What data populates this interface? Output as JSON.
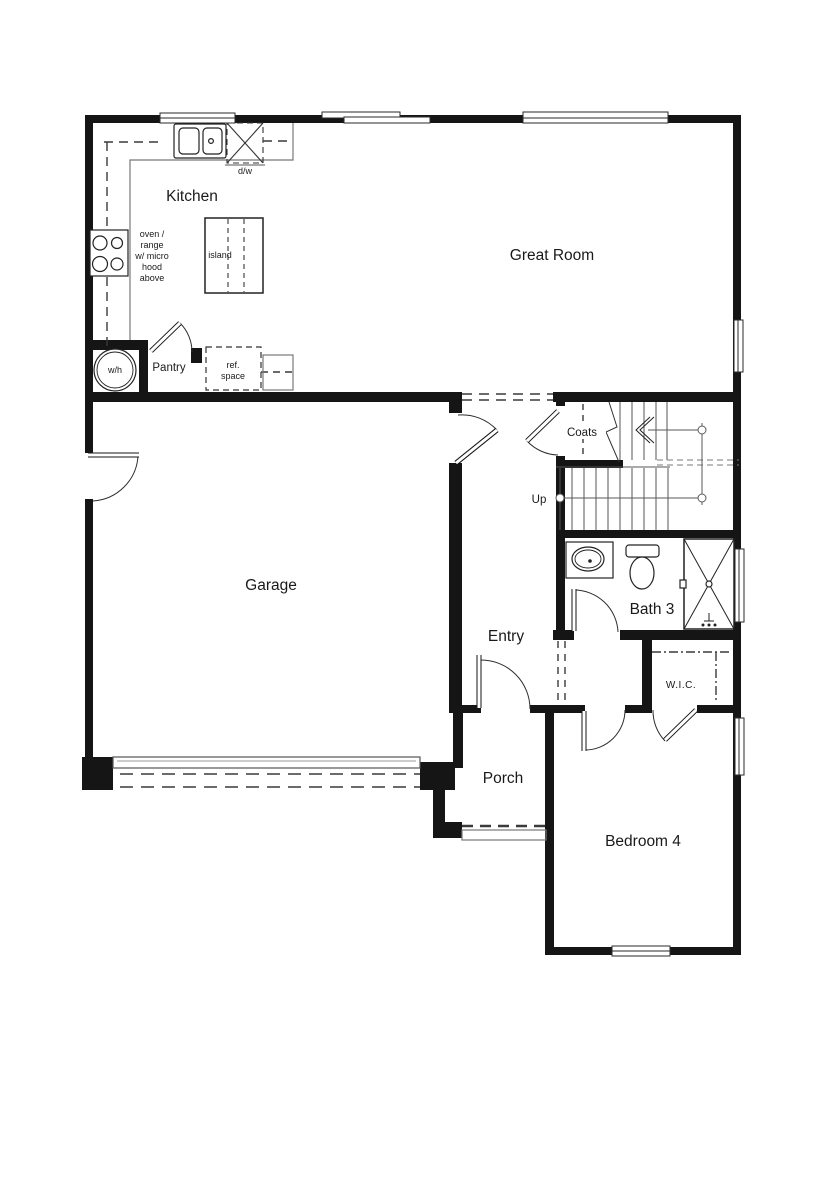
{
  "plan": {
    "title": "first-floor-plan",
    "rooms": {
      "kitchen": "Kitchen",
      "great_room": "Great Room",
      "garage": "Garage",
      "entry": "Entry",
      "porch": "Porch",
      "bedroom4": "Bedroom 4",
      "bath3": "Bath 3",
      "wic": "W.I.C.",
      "pantry": "Pantry",
      "coats": "Coats"
    },
    "labels": {
      "up": "Up",
      "wh": "w/h",
      "island": "island",
      "dw": "d/w",
      "ref_line1": "ref.",
      "ref_line2": "space",
      "range_note": [
        "oven /",
        "range",
        "w/ micro",
        "hood",
        "above"
      ]
    },
    "colors": {
      "wall": "#151515",
      "line": "#666666",
      "thin": "#7a7a7a",
      "text": "#1a1a1a",
      "background": "#ffffff"
    }
  }
}
